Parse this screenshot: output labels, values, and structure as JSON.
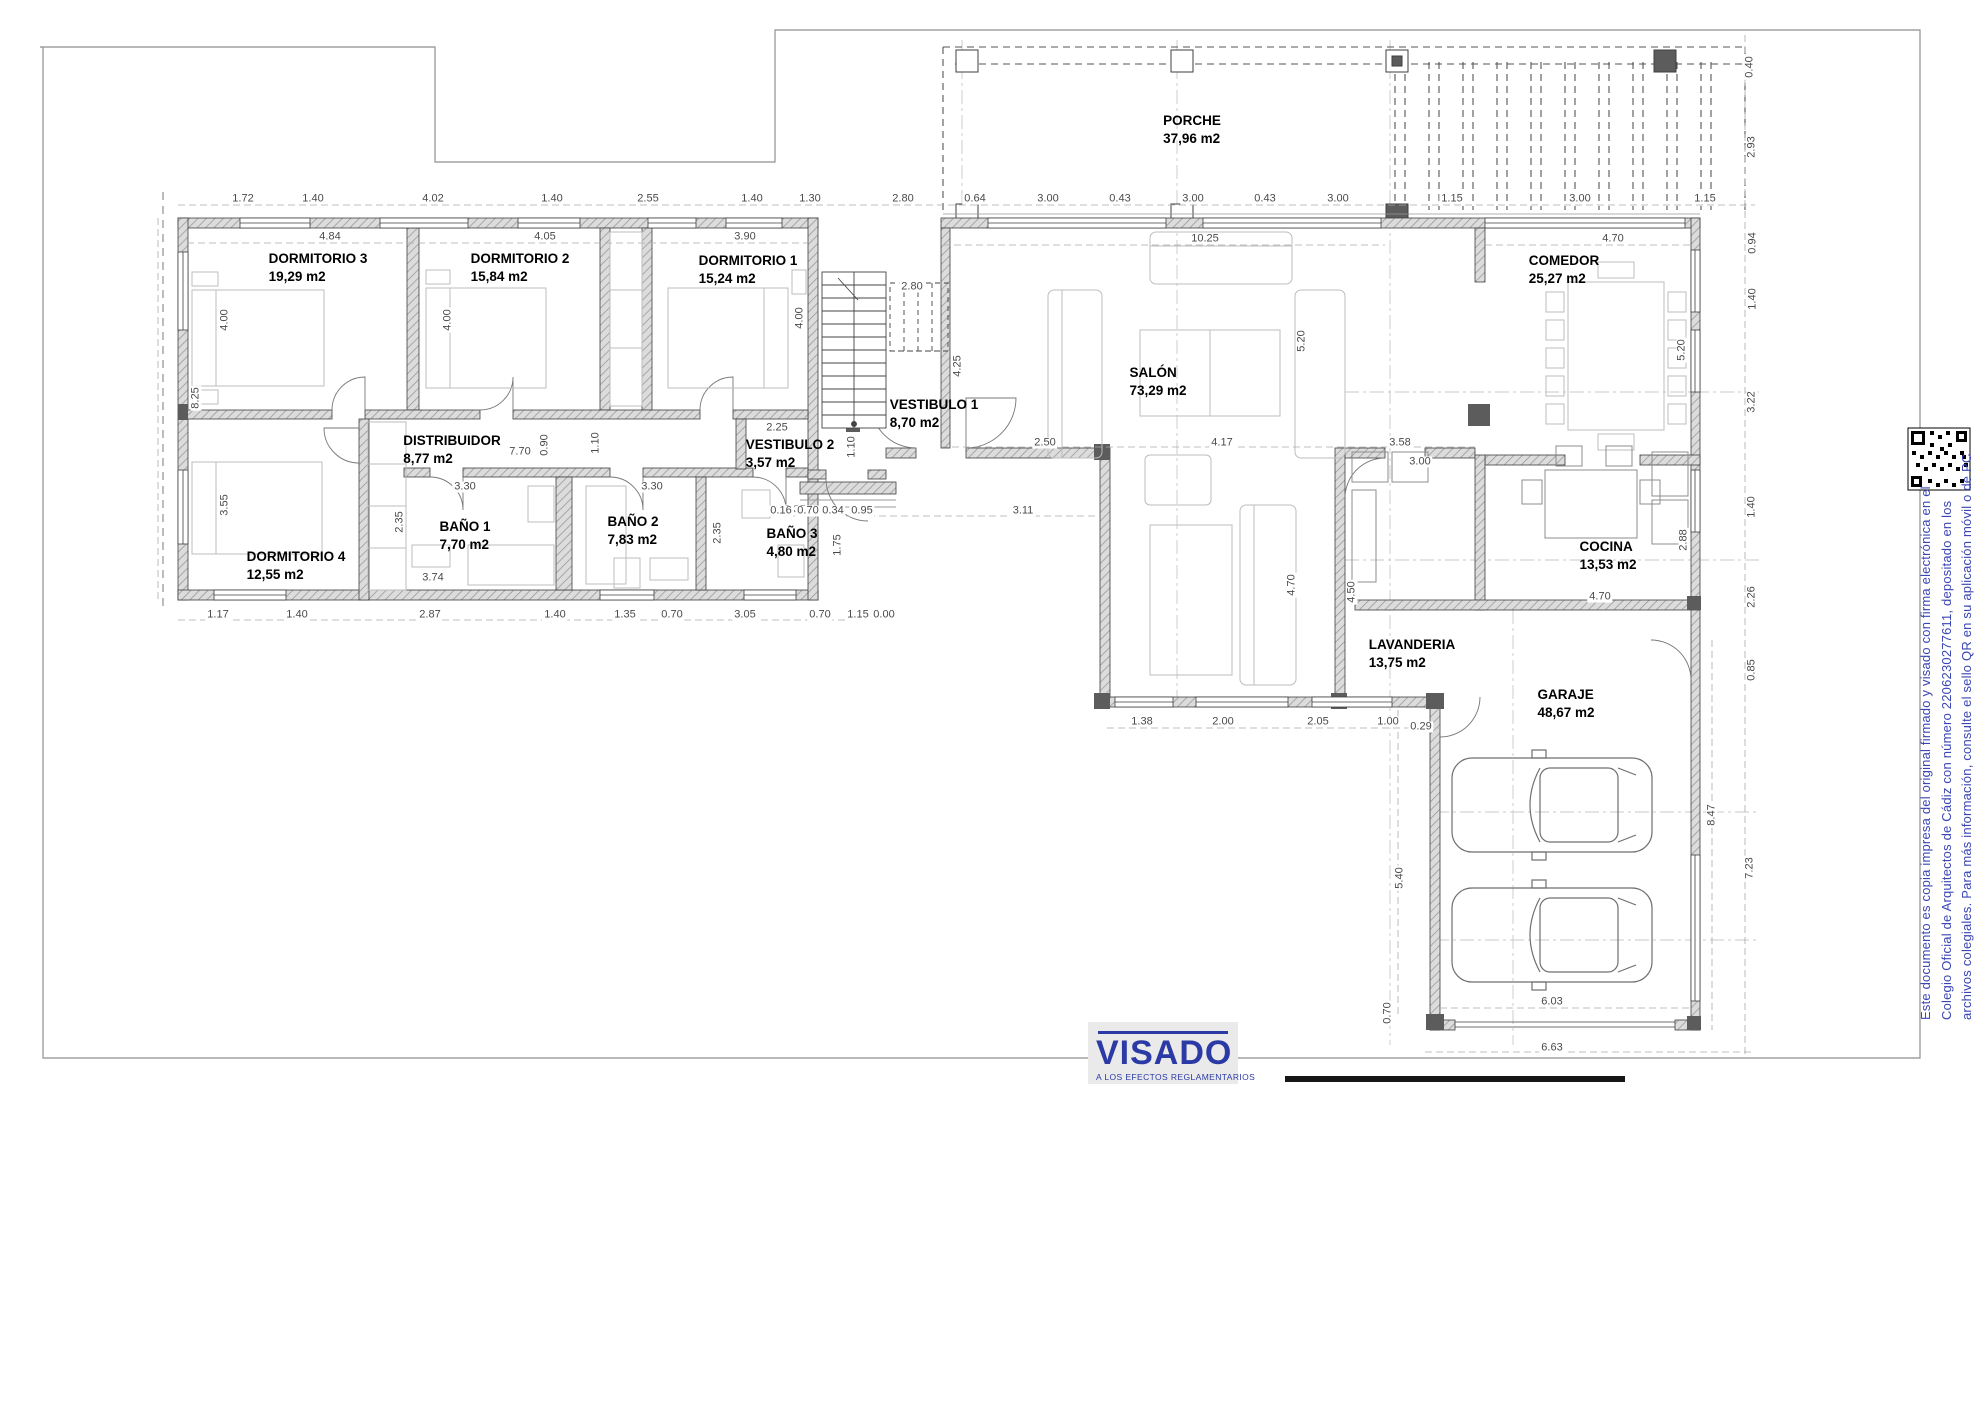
{
  "page": {
    "width": 1985,
    "height": 1404,
    "background": "#ffffff"
  },
  "plan": {
    "rooms": [
      {
        "name": "DORMITORIO 3",
        "area": "19,29 m2",
        "x": 318,
        "y": 250
      },
      {
        "name": "DORMITORIO 2",
        "area": "15,84 m2",
        "x": 520,
        "y": 250
      },
      {
        "name": "DORMITORIO 1",
        "area": "15,24 m2",
        "x": 748,
        "y": 252
      },
      {
        "name": "DORMITORIO 4",
        "area": "12,55 m2",
        "x": 296,
        "y": 548
      },
      {
        "name": "DISTRIBUIDOR",
        "area": "8,77 m2",
        "x": 452,
        "y": 432
      },
      {
        "name": "BAÑO 1",
        "area": "7,70 m2",
        "x": 465,
        "y": 518
      },
      {
        "name": "BAÑO 2",
        "area": "7,83 m2",
        "x": 633,
        "y": 513
      },
      {
        "name": "BAÑO 3",
        "area": "4,80 m2",
        "x": 792,
        "y": 525
      },
      {
        "name": "VESTIBULO 2",
        "area": "3,57 m2",
        "x": 790,
        "y": 436
      },
      {
        "name": "VESTIBULO 1",
        "area": "8,70 m2",
        "x": 934,
        "y": 396
      },
      {
        "name": "PORCHE",
        "area": "37,96 m2",
        "x": 1192,
        "y": 112
      },
      {
        "name": "SALÓN",
        "area": "73,29 m2",
        "x": 1158,
        "y": 364
      },
      {
        "name": "COMEDOR",
        "area": "25,27 m2",
        "x": 1564,
        "y": 252
      },
      {
        "name": "COCINA",
        "area": "13,53 m2",
        "x": 1608,
        "y": 538
      },
      {
        "name": "LAVANDERIA",
        "area": "13,75 m2",
        "x": 1412,
        "y": 636
      },
      {
        "name": "GARAJE",
        "area": "48,67 m2",
        "x": 1566,
        "y": 686
      }
    ],
    "dims": [
      {
        "t": "1.72",
        "x": 243,
        "y": 199,
        "r": 0
      },
      {
        "t": "1.40",
        "x": 313,
        "y": 199,
        "r": 0
      },
      {
        "t": "4.02",
        "x": 433,
        "y": 199,
        "r": 0
      },
      {
        "t": "1.40",
        "x": 552,
        "y": 199,
        "r": 0
      },
      {
        "t": "2.55",
        "x": 648,
        "y": 199,
        "r": 0
      },
      {
        "t": "1.40",
        "x": 752,
        "y": 199,
        "r": 0
      },
      {
        "t": "1.30",
        "x": 810,
        "y": 199,
        "r": 0
      },
      {
        "t": "2.80",
        "x": 903,
        "y": 199,
        "r": 0
      },
      {
        "t": "0.64",
        "x": 975,
        "y": 199,
        "r": 0
      },
      {
        "t": "3.00",
        "x": 1048,
        "y": 199,
        "r": 0
      },
      {
        "t": "0.43",
        "x": 1120,
        "y": 199,
        "r": 0
      },
      {
        "t": "3.00",
        "x": 1193,
        "y": 199,
        "r": 0
      },
      {
        "t": "0.43",
        "x": 1265,
        "y": 199,
        "r": 0
      },
      {
        "t": "3.00",
        "x": 1338,
        "y": 199,
        "r": 0
      },
      {
        "t": "1.15",
        "x": 1452,
        "y": 199,
        "r": 0
      },
      {
        "t": "3.00",
        "x": 1580,
        "y": 199,
        "r": 0
      },
      {
        "t": "1.15",
        "x": 1705,
        "y": 199,
        "r": 0
      },
      {
        "t": "4.84",
        "x": 330,
        "y": 237,
        "r": 0
      },
      {
        "t": "4.05",
        "x": 545,
        "y": 237,
        "r": 0
      },
      {
        "t": "3.90",
        "x": 745,
        "y": 237,
        "r": 0
      },
      {
        "t": "10.25",
        "x": 1205,
        "y": 239,
        "r": 0
      },
      {
        "t": "4.70",
        "x": 1613,
        "y": 239,
        "r": 0
      },
      {
        "t": "8.25",
        "x": 196,
        "y": 398,
        "r": 1
      },
      {
        "t": "4.00",
        "x": 225,
        "y": 320,
        "r": 1
      },
      {
        "t": "3.55",
        "x": 225,
        "y": 505,
        "r": 1
      },
      {
        "t": "4.00",
        "x": 448,
        "y": 320,
        "r": 1
      },
      {
        "t": "4.00",
        "x": 800,
        "y": 318,
        "r": 1
      },
      {
        "t": "7.70",
        "x": 520,
        "y": 452,
        "r": 0
      },
      {
        "t": "0.90",
        "x": 545,
        "y": 445,
        "r": 1
      },
      {
        "t": "1.10",
        "x": 596,
        "y": 443,
        "r": 1
      },
      {
        "t": "2.25",
        "x": 777,
        "y": 428,
        "r": 0
      },
      {
        "t": "1.10",
        "x": 852,
        "y": 447,
        "r": 1
      },
      {
        "t": "3.30",
        "x": 465,
        "y": 487,
        "r": 0
      },
      {
        "t": "3.30",
        "x": 652,
        "y": 487,
        "r": 0
      },
      {
        "t": "2.35",
        "x": 400,
        "y": 522,
        "r": 1
      },
      {
        "t": "2.35",
        "x": 718,
        "y": 533,
        "r": 1
      },
      {
        "t": "2.35",
        "x": 795,
        "y": 510,
        "r": 0
      },
      {
        "t": "1.75",
        "x": 838,
        "y": 545,
        "r": 1
      },
      {
        "t": "3.74",
        "x": 433,
        "y": 578,
        "r": 0
      },
      {
        "t": "1.17",
        "x": 218,
        "y": 615,
        "r": 0
      },
      {
        "t": "1.40",
        "x": 297,
        "y": 615,
        "r": 0
      },
      {
        "t": "2.87",
        "x": 430,
        "y": 615,
        "r": 0
      },
      {
        "t": "1.40",
        "x": 555,
        "y": 615,
        "r": 0
      },
      {
        "t": "1.35",
        "x": 625,
        "y": 615,
        "r": 0
      },
      {
        "t": "0.70",
        "x": 672,
        "y": 615,
        "r": 0
      },
      {
        "t": "3.05",
        "x": 745,
        "y": 615,
        "r": 0
      },
      {
        "t": "0.70",
        "x": 820,
        "y": 615,
        "r": 0
      },
      {
        "t": "1.15",
        "x": 858,
        "y": 615,
        "r": 0
      },
      {
        "t": "0.00",
        "x": 884,
        "y": 615,
        "r": 0
      },
      {
        "t": "2.80",
        "x": 912,
        "y": 287,
        "r": 0
      },
      {
        "t": "4.25",
        "x": 958,
        "y": 366,
        "r": 1
      },
      {
        "t": "0.16",
        "x": 781,
        "y": 511,
        "r": 0
      },
      {
        "t": "0.70",
        "x": 808,
        "y": 511,
        "r": 0
      },
      {
        "t": "0.34",
        "x": 833,
        "y": 511,
        "r": 0
      },
      {
        "t": "0.95",
        "x": 862,
        "y": 511,
        "r": 0
      },
      {
        "t": "3.11",
        "x": 1023,
        "y": 511,
        "r": 0
      },
      {
        "t": "2.50",
        "x": 1045,
        "y": 443,
        "r": 0
      },
      {
        "t": "4.17",
        "x": 1222,
        "y": 443,
        "r": 0
      },
      {
        "t": "3.58",
        "x": 1400,
        "y": 443,
        "r": 0
      },
      {
        "t": "5.20",
        "x": 1302,
        "y": 341,
        "r": 1
      },
      {
        "t": "5.20",
        "x": 1682,
        "y": 350,
        "r": 1
      },
      {
        "t": "3.00",
        "x": 1420,
        "y": 462,
        "r": 0
      },
      {
        "t": "4.70",
        "x": 1292,
        "y": 585,
        "r": 1
      },
      {
        "t": "4.50",
        "x": 1352,
        "y": 592,
        "r": 1
      },
      {
        "t": "1.38",
        "x": 1142,
        "y": 722,
        "r": 0
      },
      {
        "t": "2.00",
        "x": 1223,
        "y": 722,
        "r": 0
      },
      {
        "t": "2.05",
        "x": 1318,
        "y": 722,
        "r": 0
      },
      {
        "t": "1.00",
        "x": 1388,
        "y": 722,
        "r": 0
      },
      {
        "t": "0.29",
        "x": 1421,
        "y": 727,
        "r": 0
      },
      {
        "t": "4.70",
        "x": 1600,
        "y": 597,
        "r": 0
      },
      {
        "t": "2.88",
        "x": 1684,
        "y": 540,
        "r": 1
      },
      {
        "t": "0.40",
        "x": 1750,
        "y": 67,
        "r": 1
      },
      {
        "t": "2.93",
        "x": 1752,
        "y": 147,
        "r": 1
      },
      {
        "t": "0.94",
        "x": 1753,
        "y": 243,
        "r": 1
      },
      {
        "t": "1.40",
        "x": 1753,
        "y": 299,
        "r": 1
      },
      {
        "t": "3.22",
        "x": 1752,
        "y": 402,
        "r": 1
      },
      {
        "t": "1.40",
        "x": 1752,
        "y": 507,
        "r": 1
      },
      {
        "t": "2.26",
        "x": 1752,
        "y": 597,
        "r": 1
      },
      {
        "t": "0.85",
        "x": 1752,
        "y": 670,
        "r": 1
      },
      {
        "t": "8.47",
        "x": 1712,
        "y": 815,
        "r": 1
      },
      {
        "t": "7.23",
        "x": 1750,
        "y": 868,
        "r": 1
      },
      {
        "t": "5.40",
        "x": 1400,
        "y": 878,
        "r": 1
      },
      {
        "t": "0.70",
        "x": 1388,
        "y": 1013,
        "r": 1
      },
      {
        "t": "6.03",
        "x": 1552,
        "y": 1002,
        "r": 0
      },
      {
        "t": "6.63",
        "x": 1552,
        "y": 1048,
        "r": 0
      }
    ]
  },
  "stamp": {
    "title": "VISADO",
    "subtitle": "A LOS EFECTOS REGLAMENTARIOS",
    "color": "#2b3aa5"
  },
  "side_note": {
    "color": "#3a46b4",
    "lines": [
      "Este documento es copia impresa del original firmado y visado con firma electrónica en el",
      "Colegio Oficial de Arquitectos de Cádiz con número 2206230277611, depositado en los",
      "archivos colegiales. Para más información, consulte el sello QR en su aplicación móvil o de PC"
    ]
  }
}
